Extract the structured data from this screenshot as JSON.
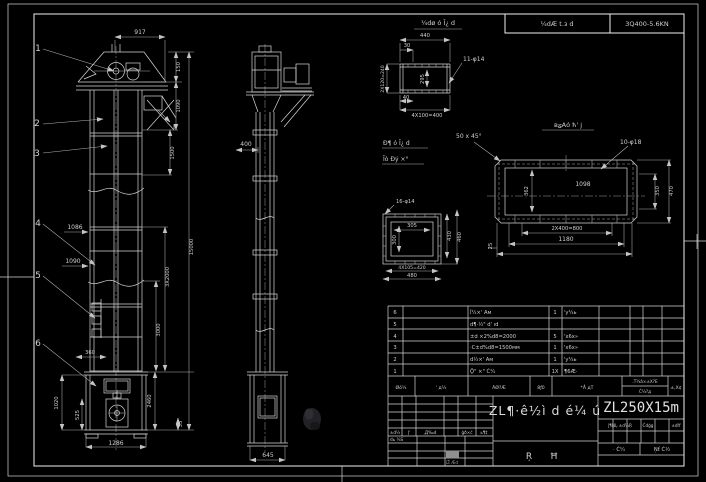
{
  "colors": {
    "background": "#000000",
    "line": "#d6d6d6"
  },
  "top_strip": {
    "left_cell": "¼dÆ t.з d",
    "right_cell": "3Q400-5.6KN"
  },
  "callouts": {
    "n1": "1",
    "n2": "2",
    "n3": "3",
    "n4": "4",
    "n5": "5",
    "n6": "6",
    "section": "I"
  },
  "front": {
    "width_917": "917",
    "h150": "150",
    "h1090": "1090",
    "h1500": "1500",
    "total_15000": "15000",
    "mid_3x2000": "3X2000",
    "mid_3000": "3000",
    "boot_2460": "2460",
    "boot_35": "35",
    "sec_1086": "1086",
    "sec_1090": "1090",
    "boot_360": "360",
    "boot_1020": "1020",
    "boot_525": "525",
    "base_1286": "1286"
  },
  "side": {
    "w400": "400",
    "base_645": "645"
  },
  "detail_top": {
    "title": "¼dø ó Ī¿ d",
    "w440": "440",
    "off30": "30",
    "left_2x120": "2X120=240",
    "inner_295": "295",
    "b40": "40",
    "b_4x100": "4X100=400",
    "holes": "11-φ14"
  },
  "detail_sq": {
    "title1": "Đ¶ ó Ī¿ d",
    "title2": "Īò Đý ×°",
    "holes": "16-φ14",
    "in_w": "305",
    "in_h": "300",
    "r1": "430",
    "r2": "460",
    "b1": "4X105=420",
    "b2": "480"
  },
  "detail_long": {
    "title": "вؽАó ћ' ј",
    "chamfer": "50 x 45°",
    "holes": "10-φ18",
    "center": "1098",
    "left_h": "362",
    "r_350": "350",
    "r_470": "470",
    "b_2x400": "2X400=800",
    "b_1180": "1180",
    "l_25": "25"
  },
  "bom": {
    "header": {
      "seq": "Øó¼",
      "code": "' д¼",
      "name": "ÃØ?Æ",
      "qty": "8ƒ0",
      "material": "*Å дТ",
      "weight_top": ".Т¼â×±Х?Е",
      "weight_bottom": "Ć¼?д",
      "remark": "±,Х¢"
    },
    "rows": [
      {
        "num": "6",
        "code": "",
        "name": "Ĭ¼×' Ам",
        "qty": "1",
        "material": "'у¼ь"
      },
      {
        "num": "5",
        "code": "",
        "name": "d¶·½\" d' ıd",
        "qty": "",
        "material": ""
      },
      {
        "num": "4",
        "code": "",
        "name": "±d ×2%d8=2000",
        "qty": "5",
        "material": "'х6х»"
      },
      {
        "num": "3",
        "code": "",
        "name": "·С±d%d8=1500мм",
        "qty": "1",
        "material": "'х6х»"
      },
      {
        "num": "2",
        "code": "",
        "name": "d½×' Ам",
        "qty": "1",
        "material": "'у¼ь"
      },
      {
        "num": "1",
        "code": "",
        "name": "Ǭ\" ×\" Ć¼",
        "qty": "1Х",
        "material": "¶6Æ·"
      }
    ]
  },
  "title_block": {
    "model": "ZL250X15m",
    "name": "ZL¶·ê½ì d é¼ ú",
    "type_char_1": "Ŗ",
    "type_char_2": "Ħ",
    "rev_labels": [
      "±d¼",
      "Į'",
      "‚Д‰d",
      "ģð×ć",
      "ь¶‡"
    ],
    "design_label": "dь ¼S",
    "stamp_label": "ïŽ Æd",
    "stage_label": "ĵ¶ŅĻ ±d¼Ŗ",
    "weight_label": "Ćdģg",
    "scale_label": "±dľf",
    "sheet_label_left": "· Ć¼",
    "sheet_label_right": "Ņť Ć½"
  }
}
